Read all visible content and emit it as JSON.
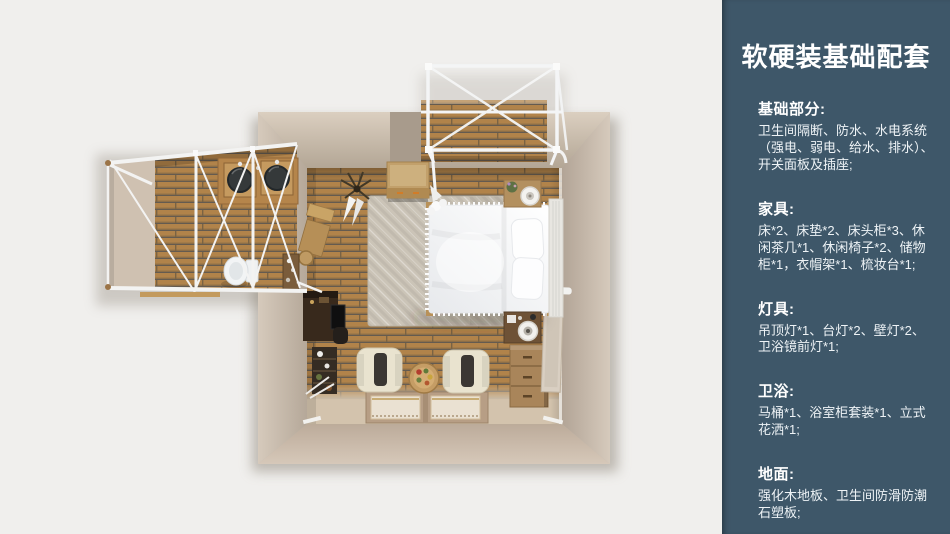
{
  "page": {
    "background": "#f0efed"
  },
  "sidebar": {
    "background": "#3e5769",
    "text_color": "#ffffff",
    "title": "软硬装基础配套",
    "sections": [
      {
        "heading": "基础部分:",
        "body": "卫生间隔断、防水、水电系统（强电、弱电、给水、排水）、开关面板及插座;"
      },
      {
        "heading": "家具:",
        "body": "床*2、床垫*2、床头柜*3、休闲茶几*1、休闲椅子*2、储物柜*1，衣帽架*1、梳妆台*1;"
      },
      {
        "heading": "灯具:",
        "body": "吊顶灯*1、台灯*2、壁灯*2、卫浴镜前灯*1;"
      },
      {
        "heading": "卫浴:",
        "body": "马桶*1、浴室柜套装*1、立式花洒*1;"
      },
      {
        "heading": "地面:",
        "body": "强化木地板、卫生间防滑防潮石塑板;"
      }
    ]
  },
  "floorplan": {
    "type": "top-down 3D interior render",
    "rooms": [
      "bedroom",
      "bathroom",
      "balcony"
    ],
    "items": [
      "double-bed",
      "headboard",
      "nightstand",
      "table-lamp",
      "storage-cabinet",
      "coat-rack",
      "area-rug",
      "lounge-chair",
      "tea-table",
      "floor-mats",
      "dresser",
      "leaning-mirror",
      "dressing-table",
      "ladder-shelf",
      "wall-shelf",
      "toilet",
      "double-sink-vanity",
      "shower-area",
      "canopy-frame",
      "wood-deck"
    ],
    "colors": {
      "wood_floor": "#b1834a",
      "wall_light": "#d8ccbd",
      "wall_dark": "#a89b8c",
      "frame_white": "#f4f5f6",
      "rug": "#cbc4b7",
      "bed": "#f8f9fa"
    }
  }
}
